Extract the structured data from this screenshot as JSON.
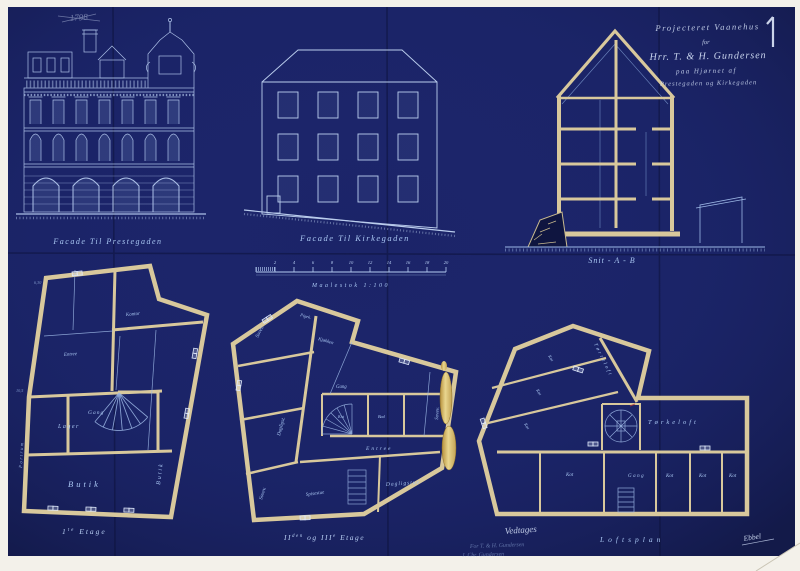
{
  "palette": {
    "blueprint_blue": "#1b2468",
    "line_blue": "#aac4ee",
    "wall_cream": "#d8c89c",
    "seal_gold": "#d8b95e",
    "paper_white": "#f3f1ea"
  },
  "header": {
    "scribble": "1798",
    "sheet_number": "1",
    "title_line1": "Projecteret Vaanehus",
    "title_line2": "for",
    "title_line3": "Hrr. T. & H. Gundersen",
    "title_line4": "paa Hjørnet af",
    "title_line5": "Prestegaden og Kirkegaden"
  },
  "elevations": {
    "prestegaden_label": "Facade Til Prestegaden",
    "kirkegaden_label": "Facade Til Kirkegaden",
    "section_label": "Snit - A - B"
  },
  "scalebar": {
    "label": "Maalestok 1:100",
    "t1": "2",
    "t2": "4",
    "t3": "6",
    "t4": "8",
    "t5": "10",
    "t6": "12",
    "t7": "14",
    "t8": "16",
    "t9": "18",
    "t10": "20"
  },
  "plan_first": {
    "label_num": "1",
    "label_sup": "te",
    "label_tail": " Etage",
    "room_butik_main": "Butik",
    "room_butik_side": "Butik",
    "room_lager": "Lager",
    "room_gang": "Gang",
    "room_kontor": "Kontor",
    "room_entree": "Entree",
    "room_portrum": "Portrum",
    "dim_a": "6,30",
    "dim_b": "10,5"
  },
  "plan_second": {
    "label_p1": "II",
    "label_sup1": "den",
    "label_mid": " og ",
    "label_p2": "III",
    "label_sup2": "e",
    "label_tail": " Etage",
    "room_sove1": "Sovev.",
    "room_sove2": "Sovev.",
    "room_sove3": "Sovev.",
    "room_daglig1": "Dagligst.",
    "room_daglig2": "Dagligstue",
    "room_spise": "Spisestue",
    "room_kjokken": "Kjøkken",
    "room_pigek": "Pigek.",
    "room_gang": "Gang",
    "room_entree": "Entree",
    "room_kot": "Kot",
    "room_bad": "Bad"
  },
  "plan_loft": {
    "label": "Loftsplan",
    "room_torreloft": "Tørreloft",
    "room_torkeloft": "Tørkeloft",
    "room_gang": "Gang",
    "kot1": "Kot",
    "kot2": "Kot",
    "kot3": "Kot",
    "kot4": "Kot",
    "kot5": "Kot",
    "kot6": "Kot",
    "kot7": "Kot"
  },
  "annotations": {
    "approval": "Vedtages",
    "signature_line1": "For T. & H. Gundersen",
    "signature_line2": "J. Chr. Gundersen",
    "architect": "Ebbel"
  }
}
